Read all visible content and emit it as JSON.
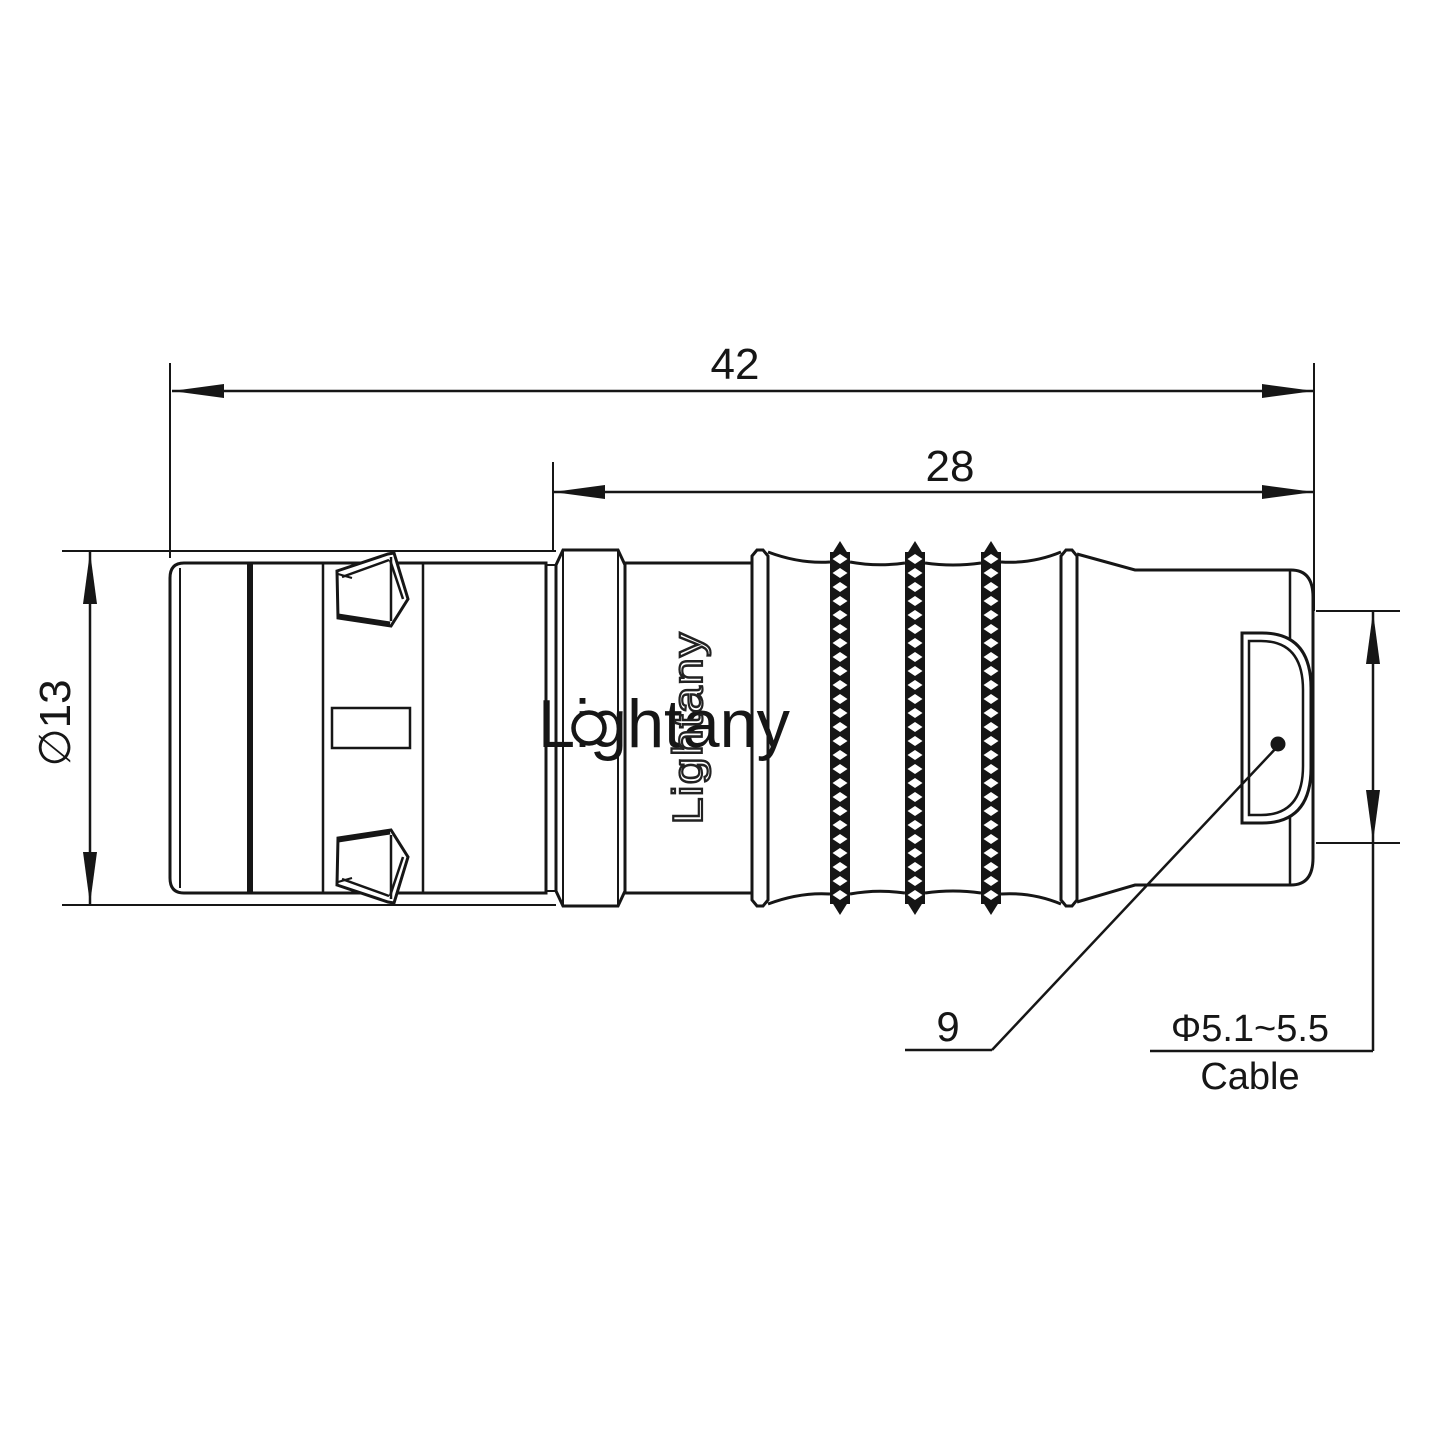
{
  "dims": {
    "total_length": "42",
    "rear_length": "28",
    "front_diameter": "∅13",
    "rear_callout": "9",
    "cable_range": "Φ5.1~5.5",
    "cable_word": "Cable"
  },
  "brand": {
    "engraving": "Lightany",
    "watermark": "Lightany"
  },
  "colors": {
    "line": "#161616",
    "watermark": "#f7caca",
    "knurl": "#151515"
  }
}
